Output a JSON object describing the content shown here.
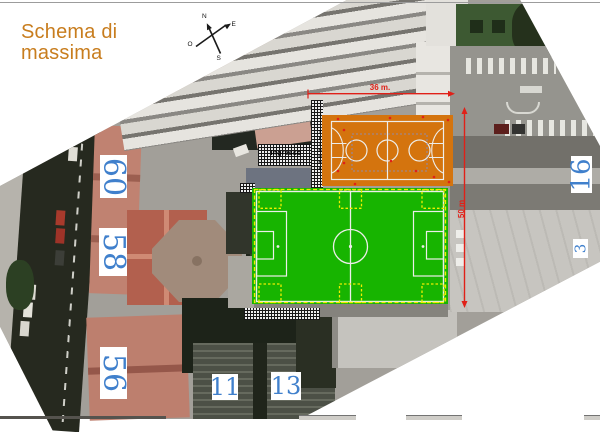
{
  "title": {
    "line1": "Schema di",
    "line2": "massima"
  },
  "compass": {
    "north": "N",
    "east": "E",
    "south": "S",
    "west": "O"
  },
  "dimensions": {
    "width": "36 m.",
    "height": "50 m"
  },
  "annotations": {
    "entrance": "Ingresso",
    "stands": "Tribuna"
  },
  "street_numbers": {
    "left": [
      "60",
      "58",
      "56"
    ],
    "right": [
      "16",
      "3"
    ],
    "bottom": [
      "11",
      "13"
    ]
  },
  "colors": {
    "title_orange": "#c87d1e",
    "field_green": "#17b400",
    "court_orange": "#d4740e",
    "dimension_red": "#e02018",
    "number_blue": "#4080cc",
    "marking_yellow": "#f0ee00",
    "marking_white": "#ededea",
    "slab_gray": "#6d7380"
  }
}
